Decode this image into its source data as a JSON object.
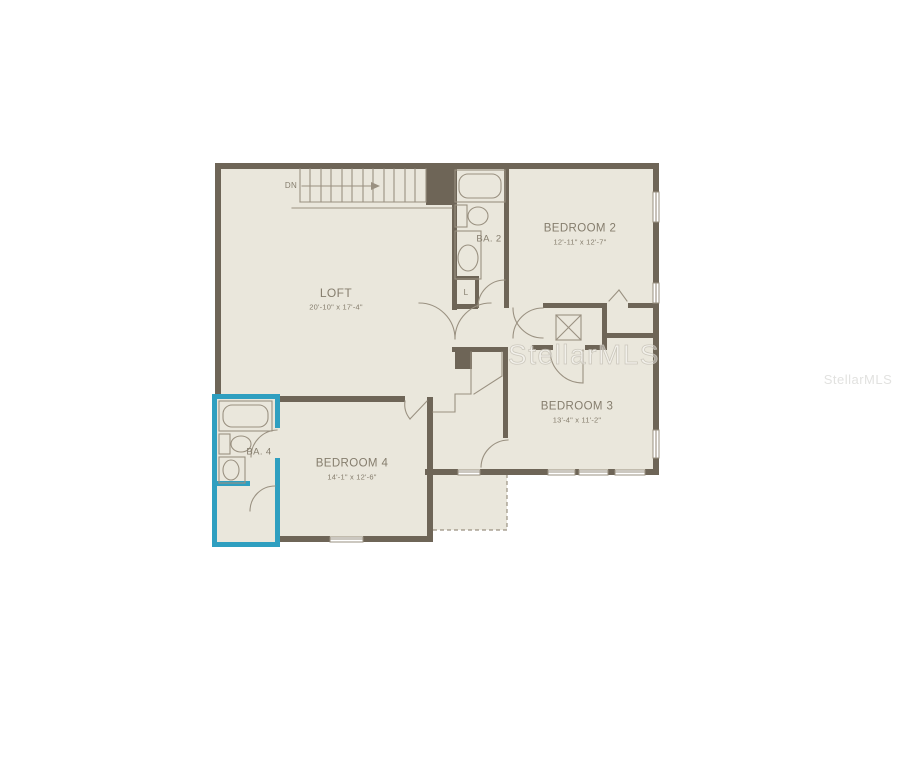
{
  "colors": {
    "wall": "#6e6557",
    "room_fill": "#eae7dc",
    "highlight": "#2f9fc0",
    "label_text": "#857d6d",
    "thin_line": "#9a9181",
    "watermark": "#c9c5ba",
    "page_bg": "#ffffff"
  },
  "watermarks": {
    "center": "StellarMLS",
    "right": "StellarMLS"
  },
  "floorplan": {
    "stairs_label": "DN",
    "rooms": [
      {
        "id": "loft",
        "name": "LOFT",
        "dims": "20'-10\" x 17'-4\""
      },
      {
        "id": "bedroom-2",
        "name": "BEDROOM 2",
        "dims": "12'-11\" x 12'-7\""
      },
      {
        "id": "bedroom-3",
        "name": "BEDROOM 3",
        "dims": "13'-4\" x 11'-2\""
      },
      {
        "id": "bedroom-4",
        "name": "BEDROOM 4",
        "dims": "14'-1\" x 12'-6\""
      },
      {
        "id": "bath-2",
        "name": "BA. 2"
      },
      {
        "id": "bath-4",
        "name": "BA. 4"
      },
      {
        "id": "linen-closet",
        "name": "L"
      }
    ]
  }
}
